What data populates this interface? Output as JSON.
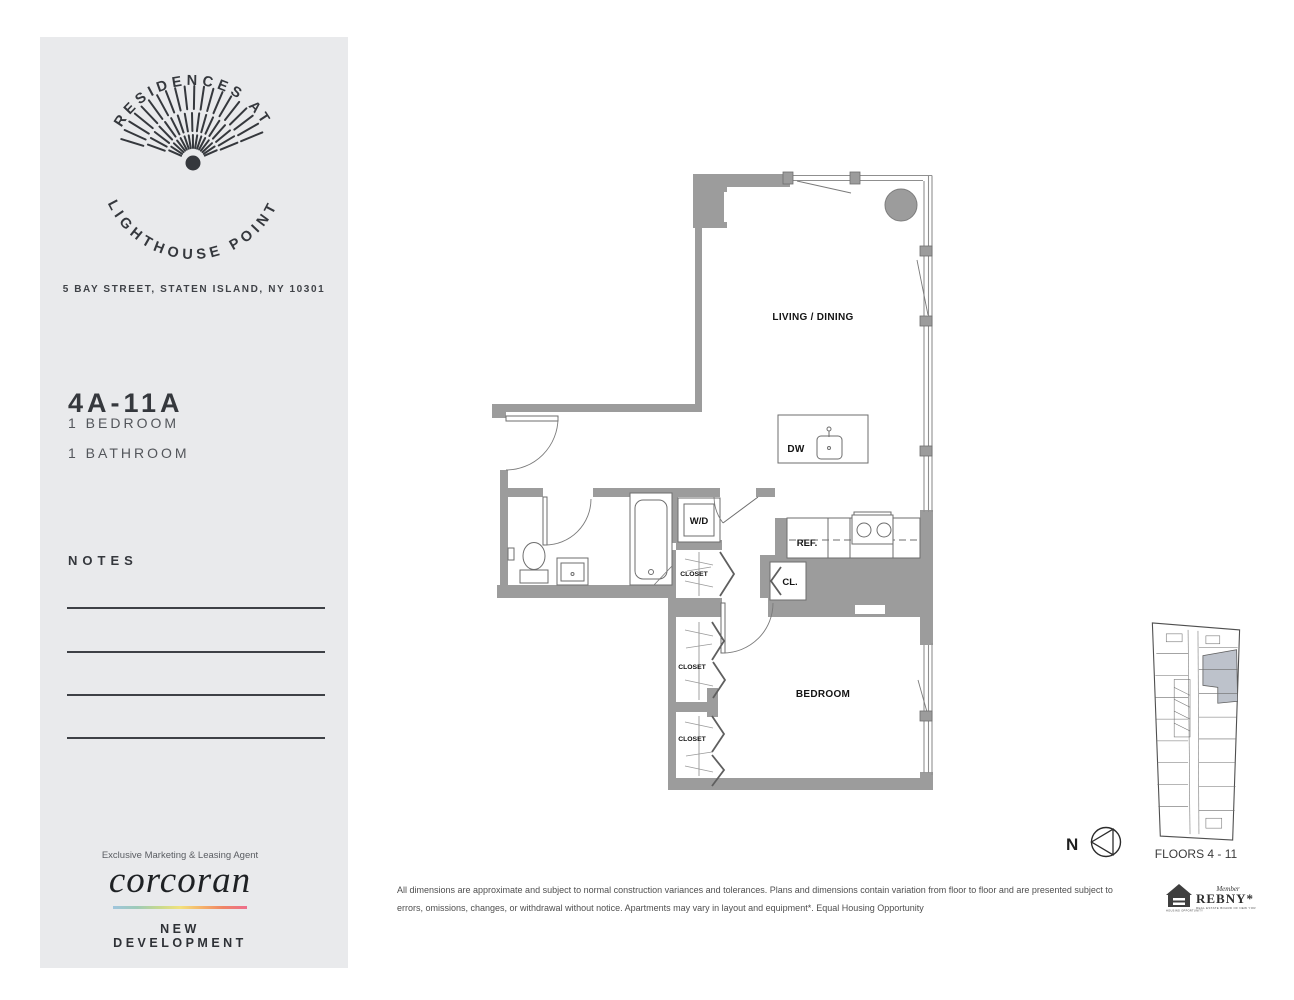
{
  "sidebar": {
    "logo": {
      "arc_top": "RESIDENCES AT",
      "arc_bottom": "LIGHTHOUSE POINT"
    },
    "address": "5 BAY STREET, STATEN ISLAND, NY 10301",
    "unit_name": "4A-11A",
    "unit_specs": [
      "1 BEDROOM",
      "1 BATHROOM"
    ],
    "notes_label": "NOTES",
    "agent": {
      "tagline": "Exclusive Marketing & Leasing Agent",
      "brand": "corcoran",
      "division": "NEW DEVELOPMENT"
    }
  },
  "floorplan": {
    "living_dining": "LIVING / DINING",
    "bedroom": "BEDROOM",
    "dw": "DW",
    "ref": "REF.",
    "wd": "W/D",
    "cl": "CL.",
    "closets": [
      "CLOSET",
      "CLOSET",
      "CLOSET"
    ]
  },
  "keyplan": {
    "caption": "FLOORS 4 - 11",
    "north": "N"
  },
  "footer": {
    "disclaimer_line1": "All dimensions are approximate and subject to normal construction variances and tolerances. Plans and dimensions contain variation from floor to floor and are presented subject to",
    "disclaimer_line2": "errors, omissions, changes, or withdrawal without notice.  Apartments may vary in layout and equipment*. Equal Housing Opportunity",
    "rebny": {
      "member": "Member",
      "name": "REBNY*",
      "tagline": "REAL ESTATE BOARD OF NEW YORK",
      "house_caption": "EQUAL HOUSING OPPORTUNITY"
    }
  },
  "colors": {
    "sidebar_bg": "#e9eaec",
    "wall_gray": "#9c9c9c",
    "text_dark": "#35383d",
    "keyplan_highlight": "#bdc2cb",
    "corcoran_gradient": [
      "#9fc5dd",
      "#9ecbb8",
      "#c5d98f",
      "#f2e27d",
      "#f5b36a",
      "#ef8566",
      "#ee6e8d"
    ]
  }
}
